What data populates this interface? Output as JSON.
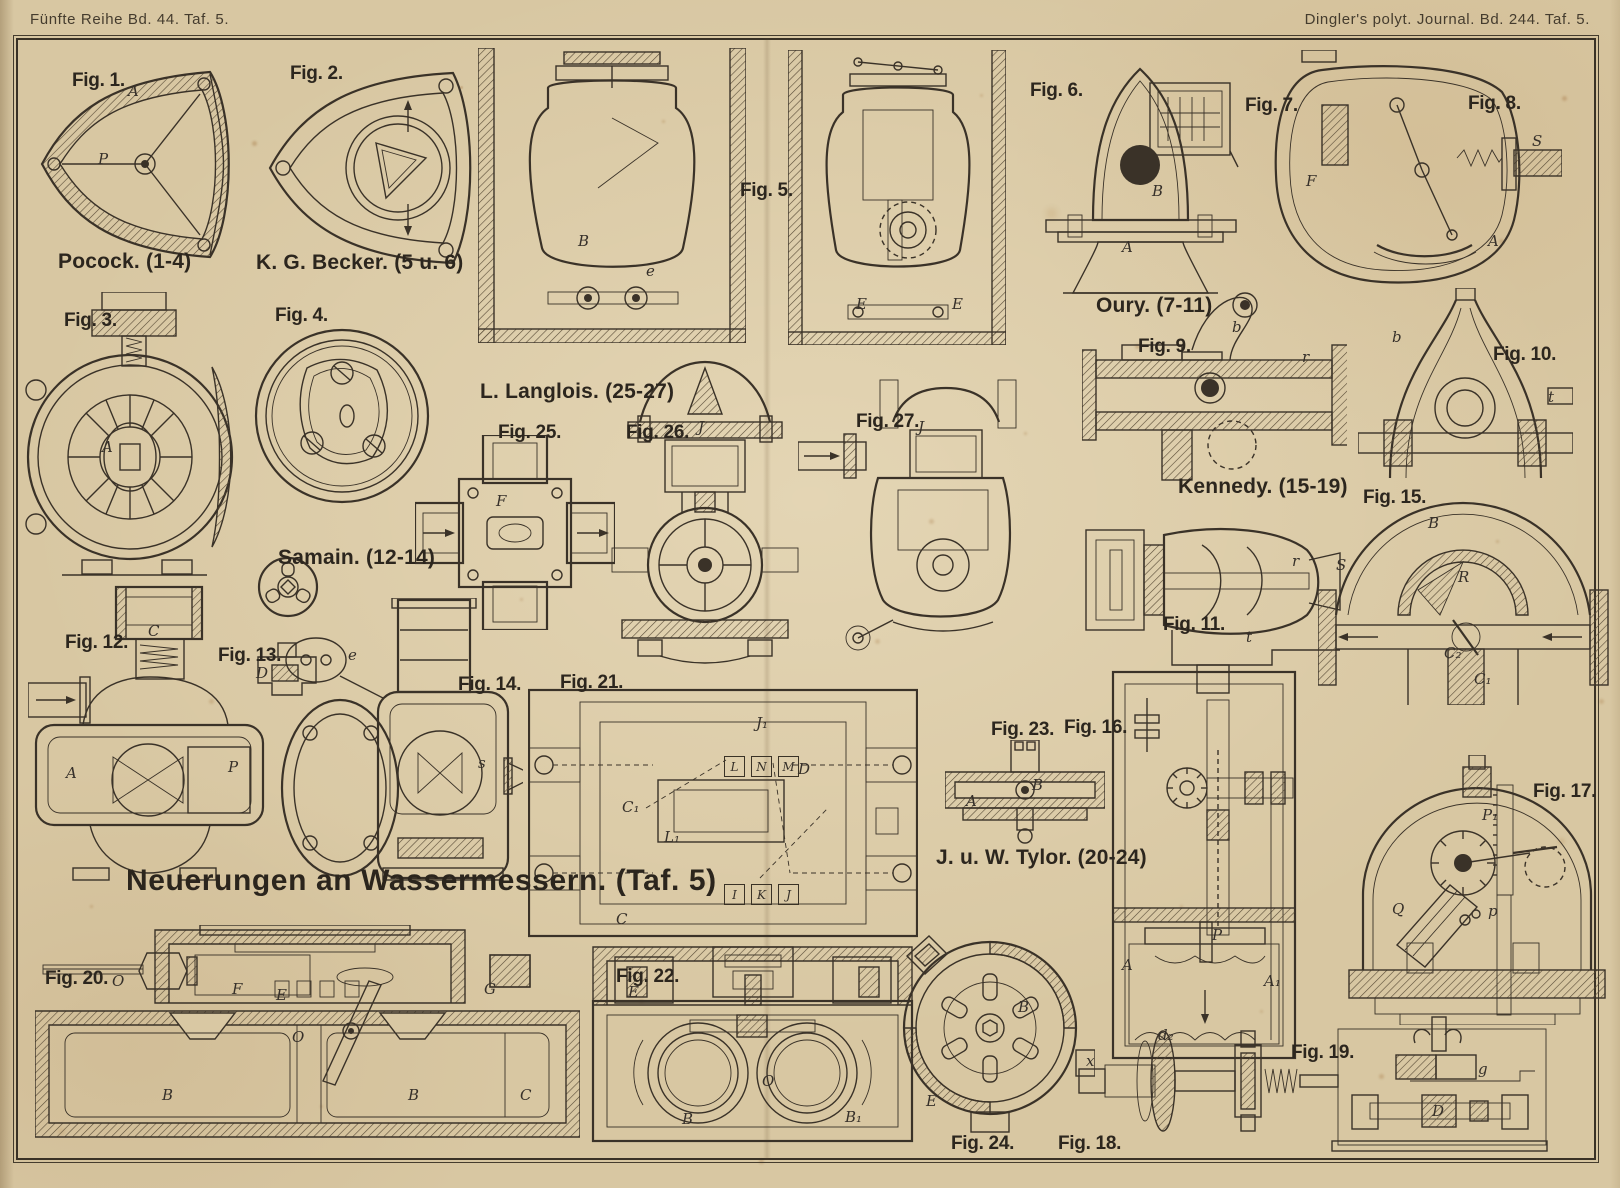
{
  "colors": {
    "paper": "#d8c7a2",
    "ink": "#3a3228"
  },
  "header": {
    "left": "Fünfte Reihe Bd. 44. Taf. 5.",
    "right": "Dingler's polyt. Journal. Bd. 244. Taf. 5."
  },
  "title": "Neuerungen an Wassermessern. (Taf. 5)",
  "groups": [
    {
      "id": "pocock",
      "label": "Pocock. (1-4)"
    },
    {
      "id": "becker",
      "label": "K. G. Becker. (5 u. 6)"
    },
    {
      "id": "oury",
      "label": "Oury. (7-11)"
    },
    {
      "id": "samain",
      "label": "Samain. (12-14)"
    },
    {
      "id": "kennedy",
      "label": "Kennedy. (15-19)"
    },
    {
      "id": "tylor",
      "label": "J. u. W. Tylor. (20-24)"
    },
    {
      "id": "langlois",
      "label": "L. Langlois. (25-27)"
    }
  ],
  "figures": [
    {
      "label": "Fig. 1.",
      "parts": [
        "A",
        "P"
      ]
    },
    {
      "label": "Fig. 2.",
      "parts": []
    },
    {
      "label": "Fig. 3.",
      "parts": [
        "A"
      ]
    },
    {
      "label": "Fig. 4.",
      "parts": []
    },
    {
      "label": "Fig. 5.",
      "parts": [
        "B",
        "e"
      ]
    },
    {
      "label": "Fig. 6.",
      "parts": [
        "E"
      ]
    },
    {
      "label": "Fig. 7.",
      "parts": [
        "B",
        "A"
      ]
    },
    {
      "label": "Fig. 8.",
      "parts": [
        "S",
        "F",
        "A"
      ]
    },
    {
      "label": "Fig. 9.",
      "parts": [
        "b",
        "r"
      ]
    },
    {
      "label": "Fig. 10.",
      "parts": [
        "b",
        "t"
      ]
    },
    {
      "label": "Fig. 11.",
      "parts": [
        "r",
        "t"
      ]
    },
    {
      "label": "Fig. 12.",
      "parts": [
        "C",
        "P",
        "A"
      ]
    },
    {
      "label": "Fig. 13.",
      "parts": [
        "D"
      ]
    },
    {
      "label": "Fig. 14.",
      "parts": [
        "e",
        "s"
      ]
    },
    {
      "label": "Fig. 15.",
      "parts": [
        "S",
        "B",
        "R",
        "C₂",
        "C₁"
      ]
    },
    {
      "label": "Fig. 16.",
      "parts": [
        "P",
        "A",
        "A₁"
      ]
    },
    {
      "label": "Fig. 17.",
      "parts": [
        "Q",
        "P₁",
        "p"
      ]
    },
    {
      "label": "Fig. 18.",
      "parts": [
        "d₂",
        "x"
      ]
    },
    {
      "label": "Fig. 19.",
      "parts": [
        "g",
        "D"
      ]
    },
    {
      "label": "Fig. 20.",
      "parts": [
        "F",
        "E",
        "G",
        "O",
        "B",
        "C"
      ]
    },
    {
      "label": "Fig. 21.",
      "parts": [
        "J₁",
        "C₁",
        "D",
        "L₁",
        "C",
        "L",
        "N",
        "M",
        "I",
        "K",
        "J"
      ]
    },
    {
      "label": "Fig. 22.",
      "parts": [
        "E",
        "O",
        "B",
        "B₁"
      ]
    },
    {
      "label": "Fig. 23.",
      "parts": [
        "A",
        "B"
      ]
    },
    {
      "label": "Fig. 24.",
      "parts": [
        "B",
        "E"
      ]
    },
    {
      "label": "Fig. 25.",
      "parts": [
        "F"
      ]
    },
    {
      "label": "Fig. 26.",
      "parts": [
        "J"
      ]
    },
    {
      "label": "Fig. 27.",
      "parts": [
        "J"
      ]
    }
  ]
}
